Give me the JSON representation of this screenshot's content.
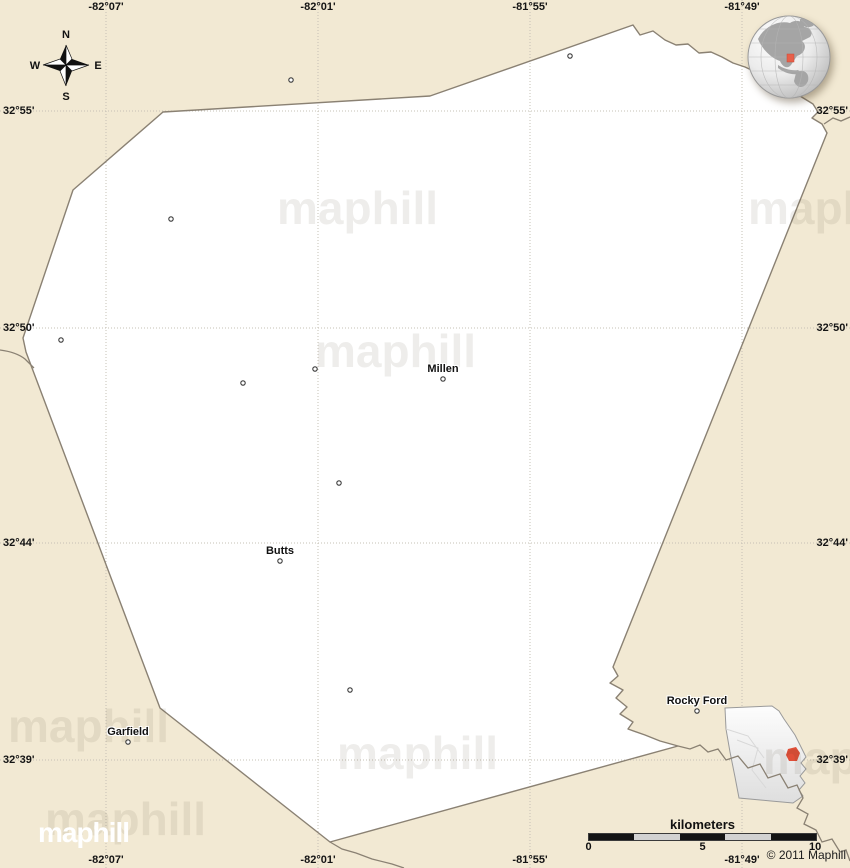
{
  "map": {
    "title_hint": "blank simple map, classic style",
    "colors": {
      "background_land": "#f2e9d3",
      "county_fill": "#ffffff",
      "boundary": "#8a8173",
      "grid": "#c5c0b4",
      "logo_red": "#e7432e",
      "inset_marker_red": "#e04f38"
    },
    "grid": {
      "meridians": [
        {
          "label": "-82°07'",
          "x": 106
        },
        {
          "label": "-82°01'",
          "x": 318
        },
        {
          "label": "-81°55'",
          "x": 530
        },
        {
          "label": "-81°49'",
          "x": 742
        }
      ],
      "parallels": [
        {
          "label": "32°55'",
          "y": 111
        },
        {
          "label": "32°50'",
          "y": 328
        },
        {
          "label": "32°44'",
          "y": 543
        },
        {
          "label": "32°39'",
          "y": 760
        }
      ]
    },
    "towns": [
      {
        "name": "Millen",
        "x": 443,
        "y": 379
      },
      {
        "name": "Butts",
        "x": 280,
        "y": 561
      },
      {
        "name": "Garfield",
        "x": 128,
        "y": 742
      },
      {
        "name": "Rocky Ford",
        "x": 697,
        "y": 711
      }
    ],
    "unnamed_markers": [
      {
        "x": 570,
        "y": 56
      },
      {
        "x": 291,
        "y": 80
      },
      {
        "x": 171,
        "y": 219
      },
      {
        "x": 61,
        "y": 340
      },
      {
        "x": 243,
        "y": 383
      },
      {
        "x": 315,
        "y": 369
      },
      {
        "x": 339,
        "y": 483
      },
      {
        "x": 350,
        "y": 690
      }
    ],
    "watermark_text": "maphill",
    "watermarks": [
      {
        "x": 277,
        "y": 181
      },
      {
        "x": 748,
        "y": 181
      },
      {
        "x": 315,
        "y": 324
      },
      {
        "x": 8,
        "y": 699
      },
      {
        "x": 337,
        "y": 726
      },
      {
        "x": 763,
        "y": 731
      },
      {
        "x": 45,
        "y": 792
      }
    ],
    "compass": {
      "north": "N",
      "east": "E",
      "south": "S",
      "west": "W"
    }
  },
  "scale_bar": {
    "unit_label": "kilometers",
    "tick_start": "0",
    "tick_mid": "5",
    "tick_end": "10"
  },
  "logo": {
    "text": "maphill"
  },
  "copyright": "© 2011 Maphill"
}
